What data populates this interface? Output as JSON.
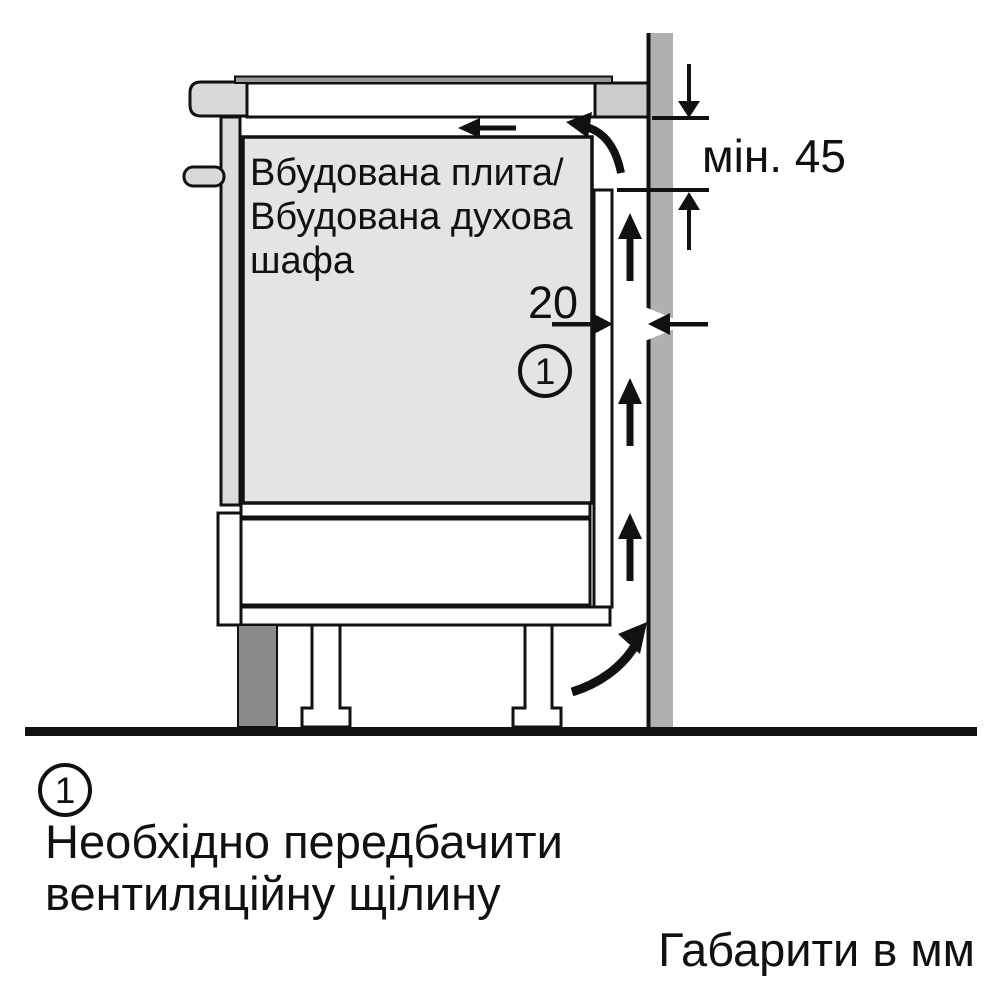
{
  "colors": {
    "outline": "#111111",
    "appliance_fill": "#e4e4e4",
    "panel_fill": "#dcdcdc",
    "worktop_cap_fill": "#d9d9d9",
    "worktop_end_fill": "#cccccc",
    "hob_strip_fill": "#999999",
    "wall_fill": "#b0b0b0",
    "plinth_fill": "#8a8a8a"
  },
  "diagram": {
    "appliance_label": {
      "line1": "Вбудована плита/",
      "line2": "Вбудована духова",
      "line3": "шафа"
    },
    "dimensions": {
      "min_clearance": "мін. 45",
      "vent_gap": "20"
    },
    "callout": "1"
  },
  "legend": {
    "callout": "1",
    "note_line1": "Необхідно передбачити",
    "note_line2": "вентиляційну щілину",
    "units": "Габарити в мм"
  }
}
